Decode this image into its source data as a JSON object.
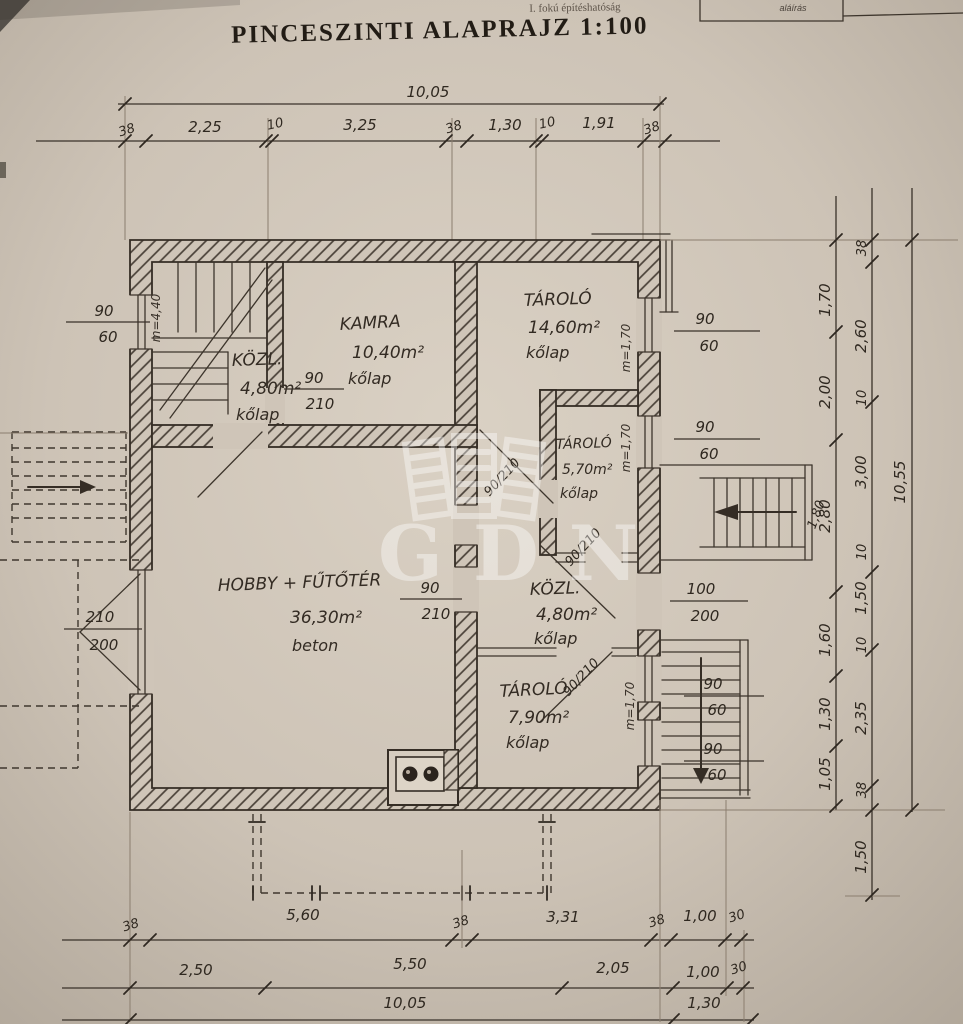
{
  "header": {
    "authority_note": "I. fokú építéshatóság",
    "signature_label": "aláírás",
    "title": "PINCESZINTI ALAPRAJZ 1:100"
  },
  "watermark": {
    "text": "GDN"
  },
  "rooms": {
    "kozl1": {
      "name": "KÖZL.",
      "area": "4,80m²",
      "floor": "kőlap"
    },
    "kamra": {
      "name": "KAMRA",
      "area": "10,40m²",
      "floor": "kőlap"
    },
    "tarolo1": {
      "name": "TÁROLÓ",
      "area": "14,60m²",
      "floor": "kőlap"
    },
    "tarolo2": {
      "name": "TÁROLÓ",
      "area": "5,70m²",
      "floor": "kőlap"
    },
    "kozl2": {
      "name": "KÖZL.",
      "area": "4,80m²",
      "floor": "kőlap"
    },
    "tarolo3": {
      "name": "TÁROLÓ",
      "area": "7,90m²",
      "floor": "kőlap"
    },
    "hobby": {
      "name": "HOBBY + FŰTŐTÉR",
      "area": "36,30m²",
      "floor": "beton"
    }
  },
  "dims": {
    "top_total": "10,05",
    "top_row": [
      "38",
      "2,25",
      "10",
      "3,25",
      "38",
      "1,30",
      "10",
      "1,91",
      "38"
    ],
    "bottom_row1": [
      "38",
      "5,60",
      "38",
      "3,31",
      "38",
      "1,00",
      "30"
    ],
    "bottom_row2": [
      "2,50",
      "5,50",
      "2,05",
      "1,00",
      "30"
    ],
    "bottom_row3": [
      "10,05",
      "1,30"
    ],
    "right_inner": [
      "1,70",
      "2,00",
      "2,80",
      "1,60",
      "1,30",
      "1,05"
    ],
    "right_mid": [
      "38",
      "2,60",
      "10",
      "3,00",
      "10",
      "1,50",
      "10",
      "2,35",
      "38",
      "1,50"
    ],
    "right_total": "10,55",
    "stair_width": "1,80"
  },
  "openings": {
    "win_left_top": {
      "w": "90",
      "h": "60"
    },
    "win_left_big": {
      "w": "210",
      "h": "200"
    },
    "door_kamra": {
      "w": "90",
      "h": "210"
    },
    "door_hobby": {
      "w": "90",
      "h": "210"
    },
    "win_right_top": {
      "w": "90",
      "h": "60"
    },
    "win_right_mid": {
      "w": "90",
      "h": "60"
    },
    "door_right": {
      "w": "100",
      "h": "200"
    },
    "win_right_low1": {
      "w": "90",
      "h": "60"
    },
    "win_right_low2": {
      "w": "90",
      "h": "60"
    },
    "door_diag1": "90/210",
    "door_diag2": "90/210",
    "door_diag3": "90/210"
  },
  "annotations": {
    "stair_note": "m=4,40",
    "parapet1": "m=1,70",
    "parapet2": "m=1,70",
    "parapet3": "m=1,70"
  },
  "colors": {
    "paper": "#cfc5b8",
    "ink": "#352d25"
  }
}
